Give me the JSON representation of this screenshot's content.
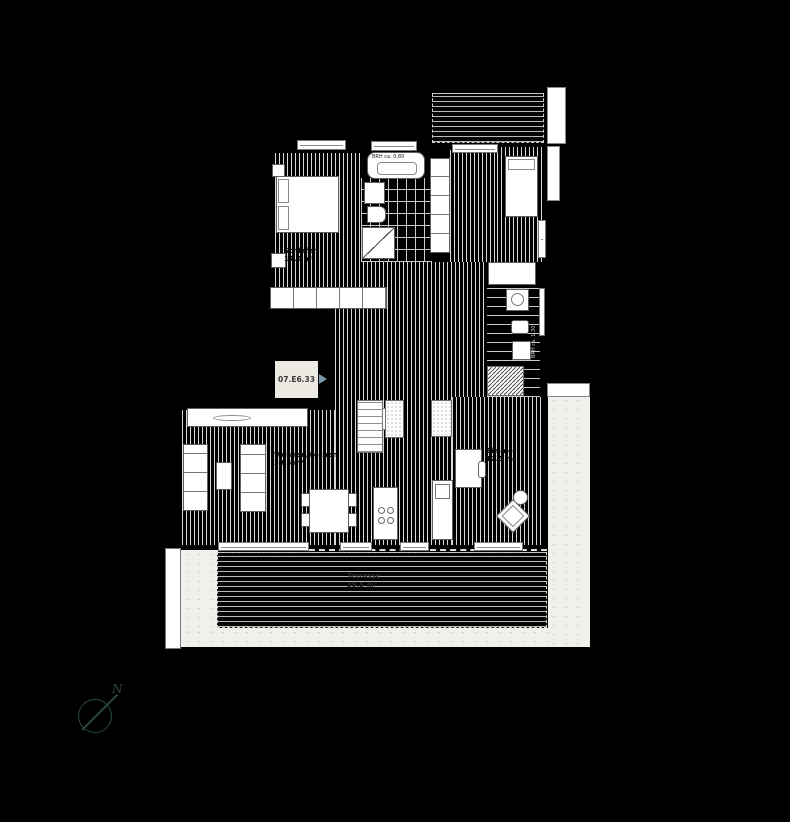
{
  "unit_tag": {
    "label": "07.E6.33"
  },
  "annotations": {
    "window_tub": "BRH ca. 0.80",
    "window_bath2": "BRH ca. 1.30"
  },
  "rooms": {
    "bedroom1": {
      "name": "Schlafen",
      "area": "14.0 m²"
    },
    "living": {
      "name": "Wohnen/Kochen",
      "area": "38.5 m²"
    },
    "zimmer": {
      "name": "Zimmer",
      "area": "12.5 m²"
    },
    "terrace": {
      "name": "Terrasse",
      "area": "39.5 m²"
    }
  },
  "compass": {
    "north": "N"
  },
  "colors": {
    "background": "#000000",
    "floor_line": "#dcdcdc",
    "outdoor": "#f2f0ea",
    "tag_bg": "#edeae3",
    "tag_arrow": "#7d97ab",
    "compass": "#2d4b3c"
  }
}
